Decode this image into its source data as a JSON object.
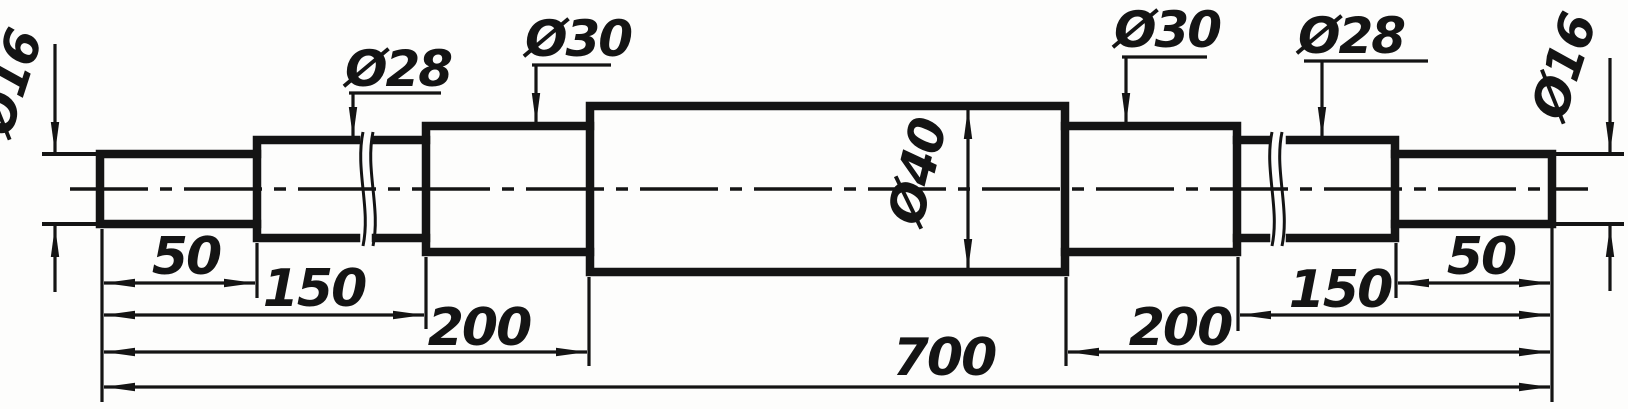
{
  "drawing": {
    "kind": "technical drawing — stepped shaft, front view",
    "units_shown": "none (bare numbers, mm implied)",
    "labels": {
      "dia_left_16": "Ø16",
      "dia_left_28": "Ø28",
      "dia_left_30": "Ø30",
      "dia_mid_40": "Ø40",
      "dia_right_30": "Ø30",
      "dia_right_28": "Ø28",
      "dia_right_16": "Ø16",
      "len_left_50": "50",
      "len_left_150": "150",
      "len_left_200": "200",
      "len_total_700": "700",
      "len_right_200": "200",
      "len_right_150": "150",
      "len_right_50": "50"
    },
    "dimension_summary": {
      "diameter_sequence": [
        "Ø16",
        "Ø28",
        "Ø30",
        "Ø40",
        "Ø30",
        "Ø28",
        "Ø16"
      ],
      "left_datum_lengths": [
        "50",
        "150",
        "200"
      ],
      "overall_length": "700",
      "right_datum_lengths": [
        "200",
        "150",
        "50"
      ],
      "break_lines_in": [
        "left Ø28 segment",
        "right Ø28 segment"
      ]
    },
    "colors": {
      "ink": "#141414",
      "paper": "#fdfdfc"
    }
  }
}
